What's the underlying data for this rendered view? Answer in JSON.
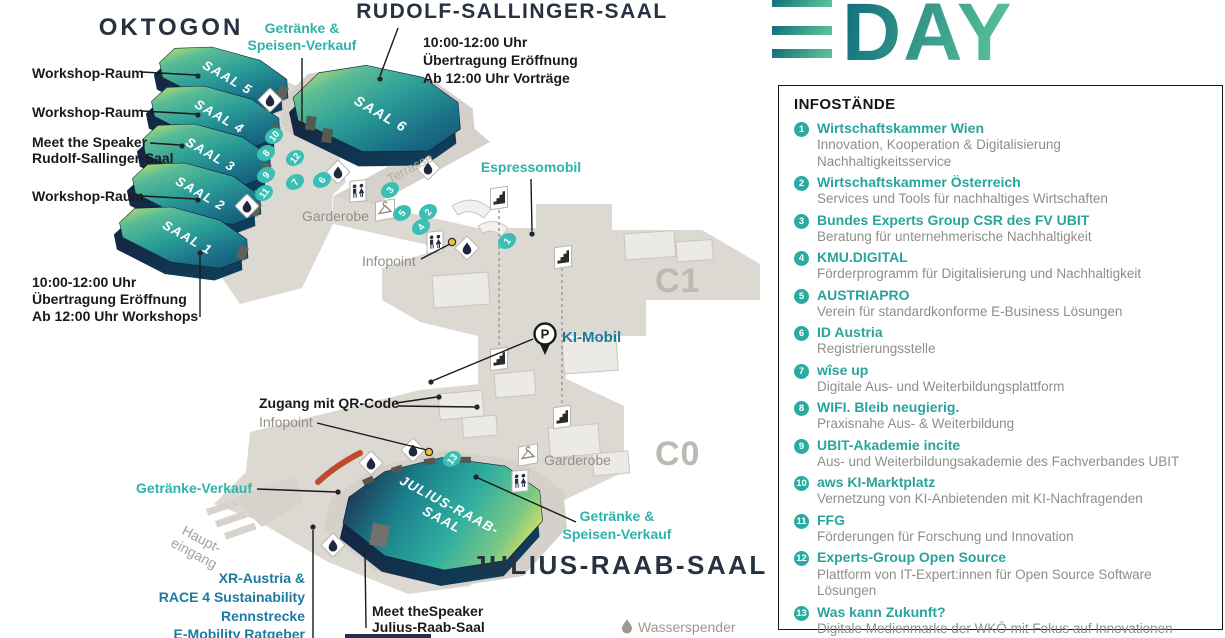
{
  "logo": {
    "word": "DAY"
  },
  "map": {
    "areas": {
      "oktogon": "OKTOGON",
      "rudolf_sallinger": "RUDOLF-SALLINGER-SAAL",
      "julius_raab": "JULIUS-RAAB-SAAL",
      "c1": "C1",
      "c0": "C0"
    },
    "halls": {
      "saal1": "SAAL 1",
      "saal2": "SAAL 2",
      "saal3": "SAAL 3",
      "saal4": "SAAL 4",
      "saal5": "SAAL 5",
      "saal6": "SAAL 6",
      "julius_line1": "JULIUS-RAAB-",
      "julius_line2": "SAAL"
    },
    "callouts": {
      "workshop1": "Workshop-Raum",
      "workshop2": "Workshop-Raum",
      "workshop3": "Workshop-Raum",
      "meet_speaker_rudolf1": "Meet the Speaker",
      "meet_speaker_rudolf2": "Rudolf-Sallinger-Saal",
      "rudolf_schedule": [
        "10:00-12:00 Uhr",
        "Übertragung Eröffnung",
        "Ab 12:00 Uhr Vorträge"
      ],
      "oktogon_schedule": [
        "10:00-12:00 Uhr",
        "Übertragung Eröffnung",
        "Ab 12:00 Uhr Workshops"
      ],
      "drinks_food_upper1": "Getränke &",
      "drinks_food_upper2": "Speisen-Verkauf",
      "espressomobil": "Espressomobil",
      "garderobe_upper": "Garderobe",
      "garderobe_lower": "Garderobe",
      "infopoint_upper": "Infopoint",
      "infopoint_lower": "Infopoint",
      "terrasse": "Terrasse",
      "ki_mobil": "KI-Mobil",
      "parking_letter": "P",
      "zugang": "Zugang mit QR-Code",
      "drinks_only": "Getränke-Verkauf",
      "drinks_food_lower1": "Getränke &",
      "drinks_food_lower2": "Speisen-Verkauf",
      "haupteingang1": "Haupt-",
      "haupteingang2": "eingang",
      "xr_block": [
        "XR-Austria &",
        "RACE 4 Sustainability",
        "Rennstrecke",
        "E-Mobility Ratgeber"
      ],
      "meet_speaker_julius1": "Meet theSpeaker",
      "meet_speaker_julius2": "Julius-Raab-Saal",
      "wasserspender": "Wasserspender"
    },
    "markers": [
      "1",
      "2",
      "3",
      "4",
      "5",
      "6",
      "7",
      "8",
      "9",
      "10",
      "11",
      "12",
      "13"
    ],
    "icons": {
      "water": "water-drop",
      "toilets": "wc",
      "cloakroom": "coat-hanger",
      "stairs": "stairs",
      "parking": "parking-p",
      "infopoint": "yellow-dot"
    }
  },
  "panel": {
    "title": "INFOSTÄNDE",
    "items": [
      {
        "num": "1",
        "title": "Wirtschaftskammer Wien",
        "desc": "Innovation, Kooperation & Digitalisierung",
        "desc2": "Nachhaltigkeitsservice"
      },
      {
        "num": "2",
        "title": "Wirtschaftskammer Österreich",
        "desc": "Services und Tools für nachhaltiges Wirtschaften"
      },
      {
        "num": "3",
        "title": "Bundes Experts Group CSR des FV UBIT",
        "desc": "Beratung für unternehmerische Nachhaltigkeit"
      },
      {
        "num": "4",
        "title": "KMU.DIGITAL",
        "desc": "Förderprogramm für Digitalisierung und Nachhaltigkeit"
      },
      {
        "num": "5",
        "title": "AUSTRIAPRO",
        "desc": "Verein für standardkonforme E-Business Lösungen"
      },
      {
        "num": "6",
        "title": "ID Austria",
        "desc": "Registrierungsstelle"
      },
      {
        "num": "7",
        "title": "wîse up",
        "desc": "Digitale Aus- und Weiterbildungsplattform"
      },
      {
        "num": "8",
        "title": "WIFI. Bleib neugierig.",
        "desc": "Praxisnahe Aus- & Weiterbildung"
      },
      {
        "num": "9",
        "title": "UBIT-Akademie incite",
        "desc": "Aus- und Weiterbildungsakademie des Fachverbandes UBIT"
      },
      {
        "num": "10",
        "title": "aws KI-Marktplatz",
        "desc": "Vernetzung von KI-Anbietenden mit KI-Nachfragenden"
      },
      {
        "num": "11",
        "title": "FFG",
        "desc": "Förderungen für Forschung und Innovation"
      },
      {
        "num": "12",
        "title": "Experts-Group Open Source",
        "desc": "Plattform von IT-Expert:innen für Open Source Software Lösungen"
      },
      {
        "num": "13",
        "title": "Was kann Zukunft?",
        "desc": "Digitale Medienmarke der WKÖ mit Fokus auf Innovationen"
      }
    ]
  },
  "colors": {
    "teal_label": "#2db3aa",
    "blue_label": "#1d7aa0",
    "marker_teal": "#3bbfb4",
    "navy": "#1d2b4a",
    "floor": "#dcd8d2",
    "gray_label": "#9b9892",
    "accent_red": "#bf4a2e",
    "info_yellow": "#f2c03c"
  }
}
